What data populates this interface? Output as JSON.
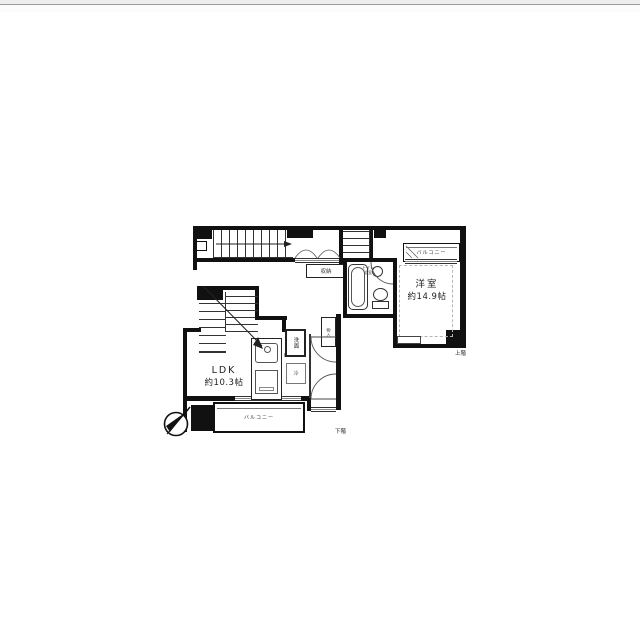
{
  "floorplan": {
    "upper_floor": {
      "bedroom": {
        "name": "洋室",
        "size": "約14.9帖"
      },
      "balcony_label": "バルコニー",
      "closet_label": "収納",
      "bath_label_line1": "トイレ",
      "bath_label_line2": "浴室",
      "floor_tag": "上階"
    },
    "lower_floor": {
      "ldk": {
        "name": "LDK",
        "size": "約10.3帖"
      },
      "balcony_label": "バルコニー",
      "kitchen_label": "K",
      "washstand_label": "洗面",
      "refrigerator_label": "冷",
      "storage_label": "物入",
      "floor_tag": "下階"
    },
    "icons": {
      "compass": "north-arrow-icon"
    },
    "colors": {
      "wall": "#111111",
      "fixture_line": "#555555",
      "page_top_border": "#9a9a9a"
    }
  }
}
